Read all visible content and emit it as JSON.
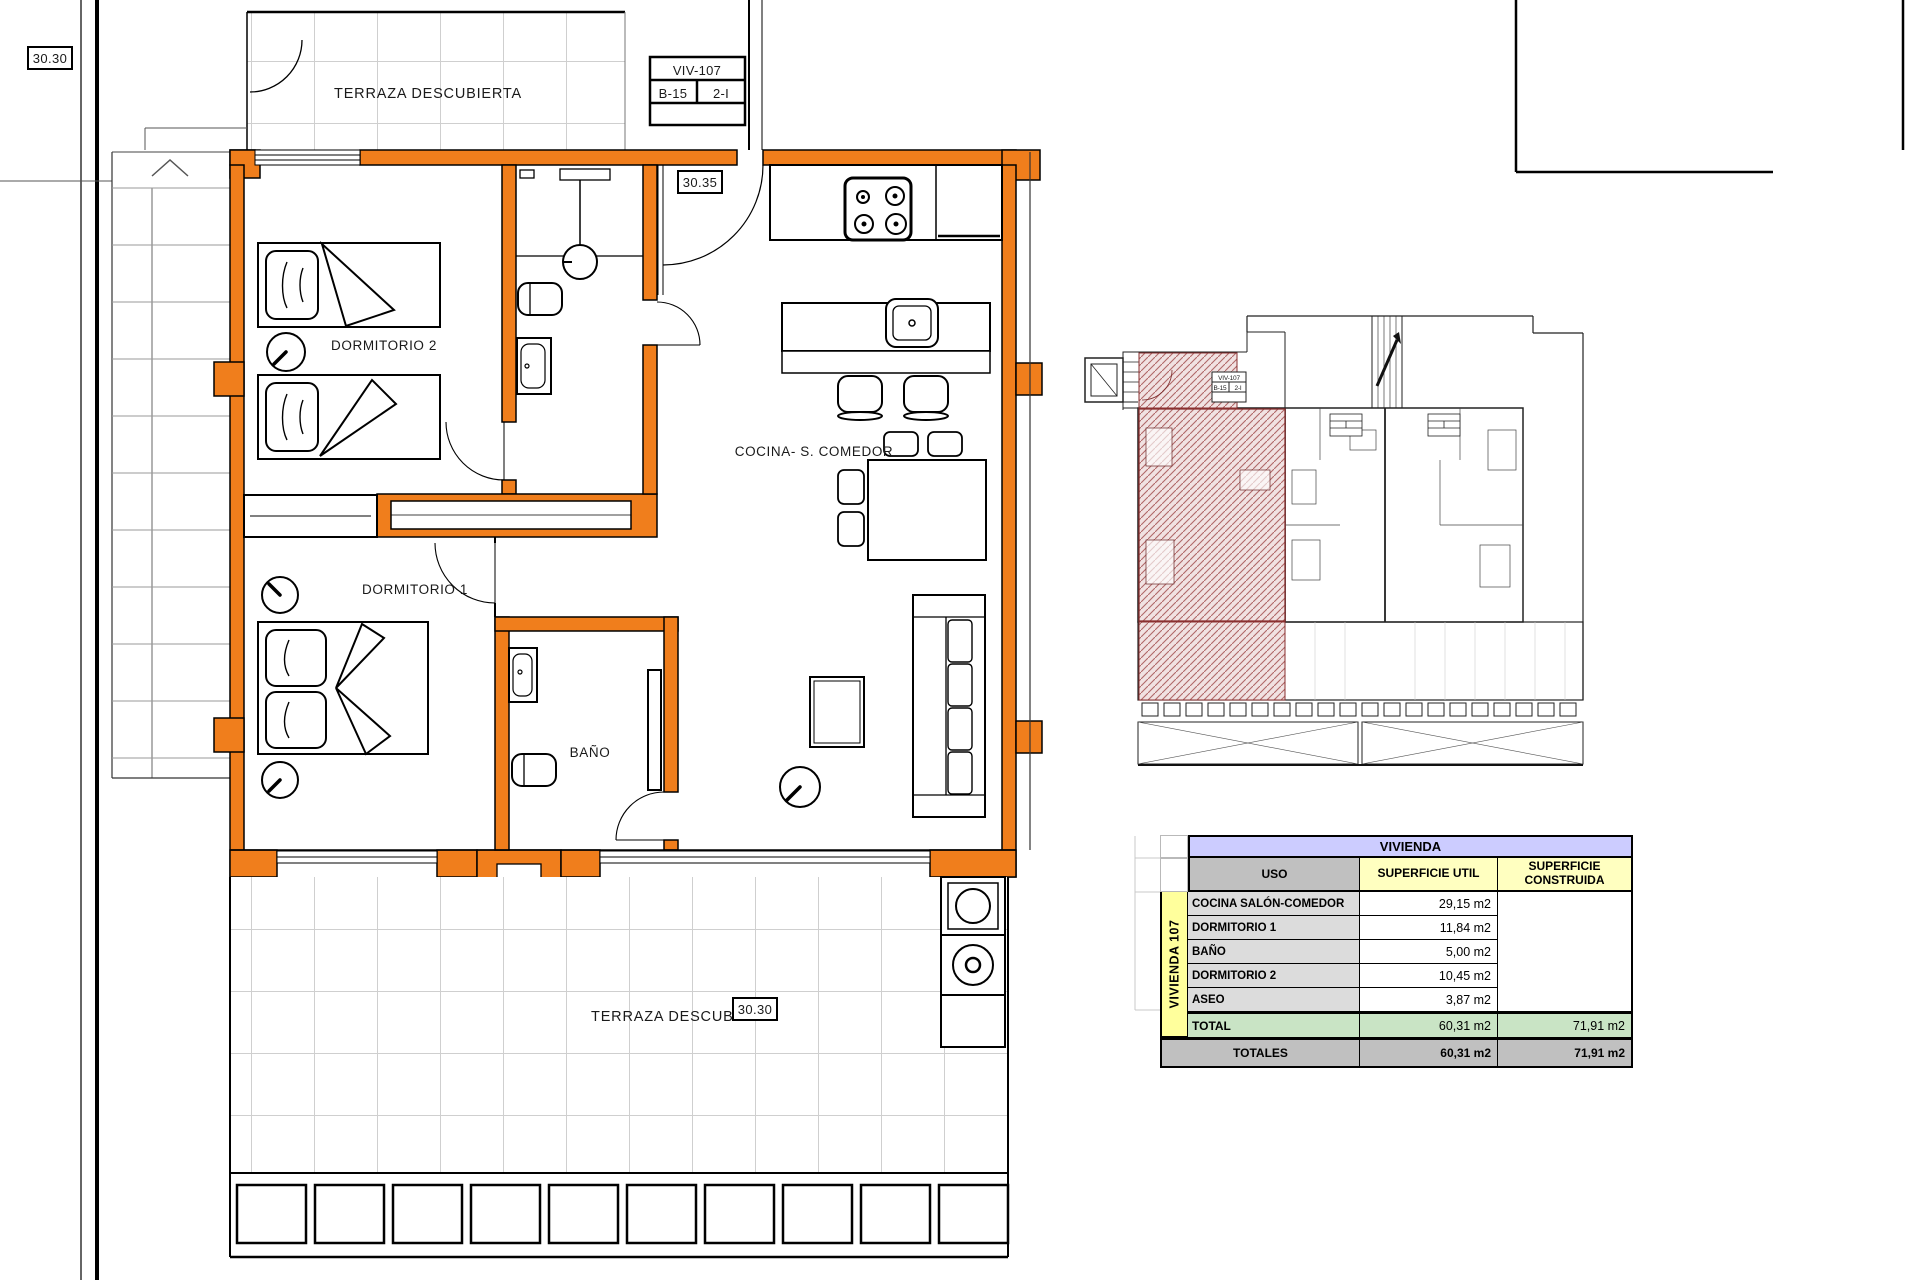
{
  "sheet": {
    "left_elevation": "30.30"
  },
  "plan": {
    "unit_box": {
      "unit": "VIV-107",
      "block": "B-15",
      "floor": "2-I"
    },
    "labels": {
      "terrace_top": "TERRAZA DESCUBIERTA",
      "dorm2": "DORMITORIO 2",
      "dorm1": "DORMITORIO 1",
      "bath": "BAÑO",
      "kitchen": "COCINA- S. COMEDOR",
      "terrace_bottom": "TERRAZA DESCUBIERTA"
    },
    "levels": {
      "hall": "30.35",
      "terrace_bottom": "30.30"
    }
  },
  "overview": {
    "unit_box": {
      "unit": "VIV-107",
      "block": "B-15",
      "floor": "2-I"
    }
  },
  "table": {
    "title": "VIVIENDA",
    "group_label": "VIVIENDA 107",
    "col_uso": "USO",
    "col_util": "SUPERFICIE UTIL",
    "col_constr1": "SUPERFICIE",
    "col_constr2": "CONSTRUIDA",
    "rows": [
      {
        "uso": "COCINA SALÓN-COMEDOR",
        "util": "29,15 m2"
      },
      {
        "uso": "DORMITORIO 1",
        "util": "11,84 m2"
      },
      {
        "uso": "BAÑO",
        "util": "5,00 m2"
      },
      {
        "uso": "DORMITORIO 2",
        "util": "10,45 m2"
      },
      {
        "uso": "ASEO",
        "util": "3,87 m2"
      }
    ],
    "total": {
      "label": "TOTAL",
      "util": "60,31 m2",
      "constr": "71,91 m2"
    },
    "totals": {
      "label": "TOTALES",
      "util": "60,31 m2",
      "constr": "71,91 m2"
    }
  },
  "drawing": {
    "wall_accent": "#F07E1C",
    "hatch_color": "#B06868",
    "table_header": "#CCCCFF",
    "table_yellow": "#FFFFC0",
    "table_group_yellow": "#FFFF9C",
    "table_gray": "#C0C0C0",
    "table_label_gray": "#DCDCDC",
    "table_total_green": "#C9E4C5"
  }
}
